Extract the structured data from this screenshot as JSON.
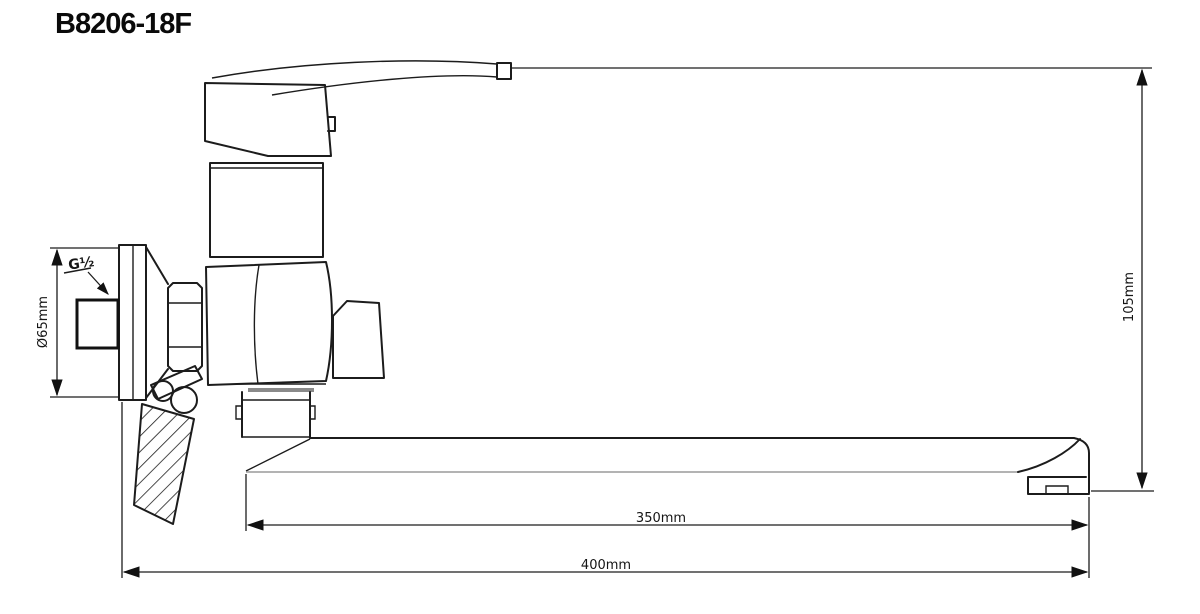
{
  "title": "B8206-18F",
  "drawing": {
    "type": "technical-line-drawing",
    "subject": "wall-mounted single-lever bath mixer faucet with long spout, side elevation",
    "labels": {
      "height": "105mm",
      "spout_reach": "350mm",
      "overall_length": "400mm",
      "flange_diameter": "Ø65mm",
      "inlet_thread": "G½"
    }
  }
}
